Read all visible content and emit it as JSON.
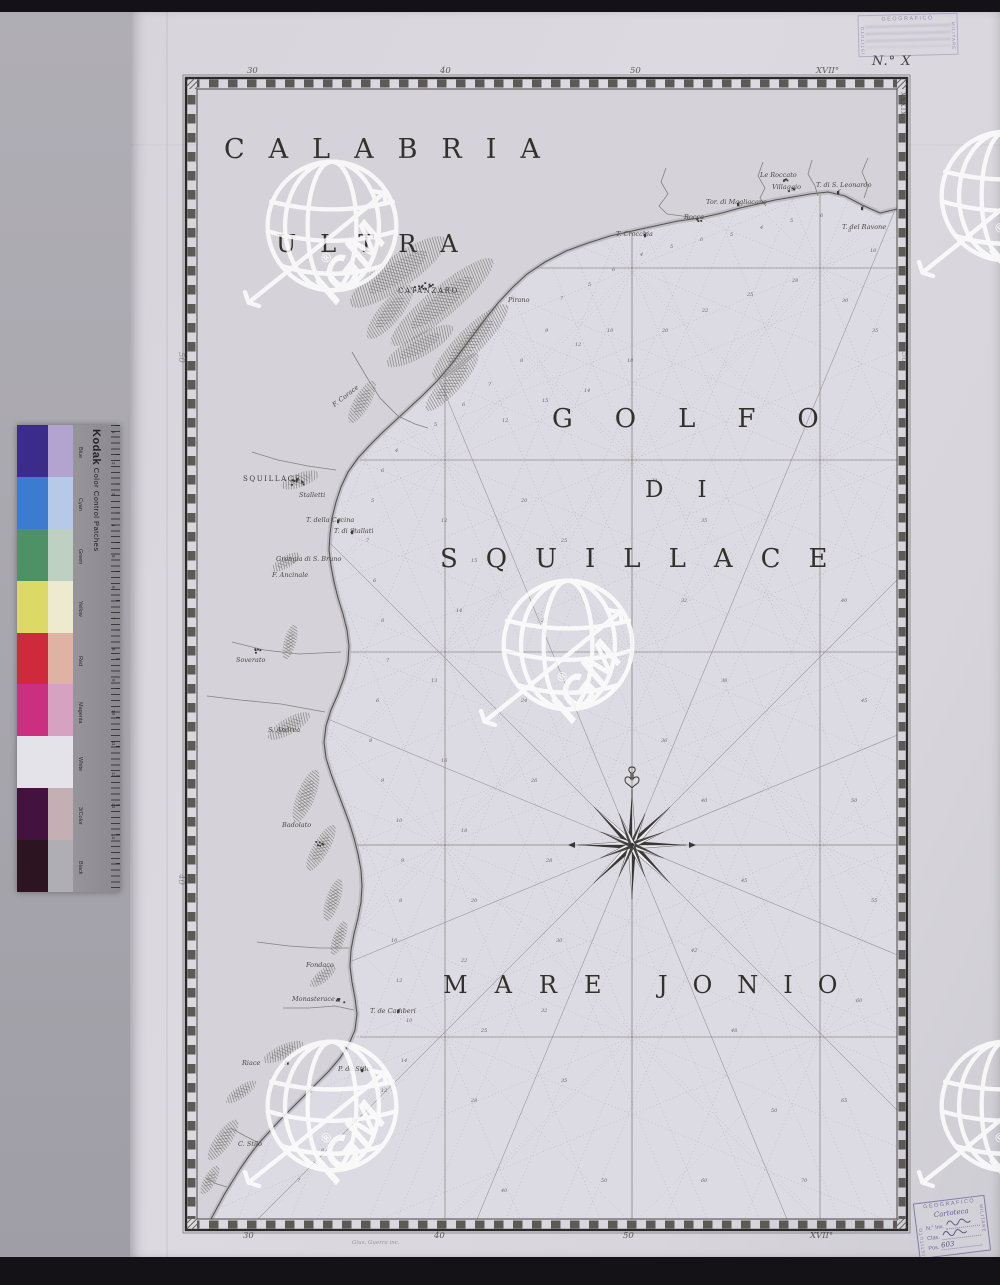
{
  "plate_number": "N.° X",
  "engraver_credit": "Gius. Guerra inc.",
  "watermark": {
    "label": "IGM",
    "reg": "®"
  },
  "stamps": {
    "top": {
      "org_left": "ISTITUTO",
      "org_top": "GEOGRAFICO",
      "org_right": "MILITARE"
    },
    "bottom": {
      "org_top": "GEOGRAFICO",
      "org_left": "ISTITUTO",
      "org_right": "MILITARE",
      "script": "Cartoteca",
      "fields": [
        {
          "label": "N.° Inv.",
          "value": ""
        },
        {
          "label": "Clas.",
          "value": ""
        },
        {
          "label": "Pos.",
          "value": "603"
        }
      ]
    }
  },
  "kodak": {
    "brand": "Kodak",
    "title": "Color Control Patches",
    "rows": [
      {
        "name": "Blue",
        "left": "#3b2b8b",
        "right": "#b3a4cf"
      },
      {
        "name": "Cyan",
        "left": "#3d7bd0",
        "right": "#b6c9e8"
      },
      {
        "name": "Green",
        "left": "#4e9166",
        "right": "#bdd0c1"
      },
      {
        "name": "Yellow",
        "left": "#ddd967",
        "right": "#eeeacf"
      },
      {
        "name": "Red",
        "left": "#cf2a3c",
        "right": "#dfb3a4"
      },
      {
        "name": "Magenta",
        "left": "#cc2f7f",
        "right": "#d5a2c2"
      },
      {
        "name": "White",
        "left": "#e4e3e9",
        "right": "#e4e3e9"
      },
      {
        "name": "3/Color",
        "left": "#43123f",
        "right": "#c4afb4"
      },
      {
        "name": "Black",
        "left": "#2c1420",
        "right": "#aeaeb4"
      }
    ],
    "ruler_numbers": [
      "1",
      "2",
      "3",
      "4",
      "5",
      "6",
      "7",
      "8",
      "9",
      "10",
      "11",
      "12",
      "13",
      "14"
    ]
  },
  "map": {
    "frame": {
      "outer": [
        186,
        78,
        907,
        1230
      ],
      "inner": [
        197,
        89,
        897,
        1219
      ]
    },
    "titles": [
      {
        "text": "CALABRIA",
        "x": 224,
        "y": 134,
        "fs": 27,
        "ls": 24
      },
      {
        "text": "ULTRA",
        "x": 276,
        "y": 230,
        "fs": 24,
        "ls": 24
      },
      {
        "text": "GOLFO",
        "x": 552,
        "y": 404,
        "fs": 26,
        "ls": 42
      },
      {
        "text": "DI",
        "x": 645,
        "y": 477,
        "fs": 23,
        "ls": 34
      },
      {
        "text": "SQUILLACE",
        "x": 440,
        "y": 544,
        "fs": 26,
        "ls": 28
      },
      {
        "text": "MARE",
        "x": 443,
        "y": 971,
        "fs": 24,
        "ls": 27
      },
      {
        "text": "JONIO",
        "x": 658,
        "y": 971,
        "fs": 24,
        "ls": 25
      }
    ],
    "towns_caps": [
      {
        "text": "CATANZARO",
        "x": 398,
        "y": 287
      },
      {
        "text": "SQUILLACE",
        "x": 243,
        "y": 475
      }
    ],
    "places": [
      [
        "Pirano",
        508,
        296
      ],
      [
        "T. Crocchia",
        616,
        230
      ],
      [
        "Rocca",
        684,
        213
      ],
      [
        "Tor. di Magliacane",
        706,
        198
      ],
      [
        "Le Roccato",
        760,
        171
      ],
      [
        "Villaggio",
        772,
        183
      ],
      [
        "T. di S. Leonardo",
        816,
        181
      ],
      [
        "T. del Ravone",
        842,
        223
      ],
      [
        "Stalletti",
        299,
        491
      ],
      [
        "T. della Cocina",
        306,
        516
      ],
      [
        "T. di Stallati",
        334,
        527
      ],
      [
        "Grangia di S. Bruno",
        276,
        555
      ],
      [
        "F. Ancinale",
        272,
        571
      ],
      [
        "Soverato",
        236,
        656
      ],
      [
        "S. Andrea",
        268,
        726
      ],
      [
        "Badolato",
        282,
        821
      ],
      [
        "Fondaco",
        306,
        961
      ],
      [
        "Monasterace",
        292,
        995
      ],
      [
        "T. de Camberi",
        370,
        1007
      ],
      [
        "Riace",
        242,
        1059
      ],
      [
        "P. de Stilo",
        338,
        1065
      ],
      [
        "C. Stilo",
        238,
        1140
      ],
      [
        "F. Corace",
        330,
        392,
        -38
      ]
    ],
    "border": {
      "top": [
        [
          "30",
          247
        ],
        [
          "40",
          440
        ],
        [
          "50",
          630
        ],
        [
          "XVII°",
          816
        ]
      ],
      "bottom": [
        [
          "30",
          243
        ],
        [
          "40",
          434
        ],
        [
          "50",
          623
        ],
        [
          "XVII°",
          810
        ]
      ],
      "left": [
        [
          "50",
          352
        ],
        [
          "40",
          874
        ]
      ],
      "right": [
        [
          "50",
          352
        ],
        [
          "40",
          874
        ]
      ],
      "roman": "XXXIX"
    },
    "grid": {
      "verticals": [
        [
          445,
          372
        ],
        [
          632,
          233
        ],
        [
          820,
          195
        ]
      ],
      "horizontals": [
        [
          268,
          537
        ],
        [
          460,
          360
        ],
        [
          652,
          351
        ],
        [
          845,
          358
        ],
        [
          1037,
          360
        ]
      ]
    },
    "rose": {
      "x": 632,
      "y": 845
    },
    "coast": [
      [
        897,
        209
      ],
      [
        880,
        213
      ],
      [
        862,
        205
      ],
      [
        845,
        196
      ],
      [
        828,
        192
      ],
      [
        810,
        194
      ],
      [
        793,
        197
      ],
      [
        775,
        200
      ],
      [
        758,
        204
      ],
      [
        740,
        208
      ],
      [
        722,
        213
      ],
      [
        700,
        218
      ],
      [
        678,
        221
      ],
      [
        655,
        226
      ],
      [
        632,
        231
      ],
      [
        610,
        236
      ],
      [
        588,
        243
      ],
      [
        566,
        251
      ],
      [
        545,
        262
      ],
      [
        527,
        274
      ],
      [
        512,
        288
      ],
      [
        498,
        303
      ],
      [
        486,
        318
      ],
      [
        474,
        334
      ],
      [
        462,
        350
      ],
      [
        450,
        366
      ],
      [
        437,
        381
      ],
      [
        423,
        395
      ],
      [
        409,
        408
      ],
      [
        396,
        420
      ],
      [
        383,
        432
      ],
      [
        370,
        445
      ],
      [
        358,
        458
      ],
      [
        348,
        472
      ],
      [
        341,
        487
      ],
      [
        336,
        502
      ],
      [
        332,
        518
      ],
      [
        330,
        534
      ],
      [
        329,
        550
      ],
      [
        331,
        566
      ],
      [
        334,
        582
      ],
      [
        338,
        598
      ],
      [
        343,
        614
      ],
      [
        347,
        630
      ],
      [
        349,
        646
      ],
      [
        348,
        662
      ],
      [
        344,
        678
      ],
      [
        338,
        694
      ],
      [
        331,
        710
      ],
      [
        326,
        726
      ],
      [
        324,
        742
      ],
      [
        326,
        758
      ],
      [
        331,
        774
      ],
      [
        337,
        790
      ],
      [
        343,
        806
      ],
      [
        349,
        822
      ],
      [
        354,
        838
      ],
      [
        358,
        854
      ],
      [
        361,
        870
      ],
      [
        362,
        886
      ],
      [
        361,
        902
      ],
      [
        358,
        918
      ],
      [
        354,
        934
      ],
      [
        351,
        950
      ],
      [
        350,
        966
      ],
      [
        352,
        982
      ],
      [
        355,
        998
      ],
      [
        357,
        1014
      ],
      [
        355,
        1030
      ],
      [
        349,
        1044
      ],
      [
        340,
        1058
      ],
      [
        329,
        1071
      ],
      [
        317,
        1083
      ],
      [
        305,
        1095
      ],
      [
        293,
        1107
      ],
      [
        281,
        1119
      ],
      [
        270,
        1131
      ],
      [
        259,
        1143
      ],
      [
        249,
        1156
      ],
      [
        240,
        1169
      ],
      [
        232,
        1182
      ],
      [
        224,
        1195
      ],
      [
        217,
        1208
      ],
      [
        211,
        1219
      ]
    ],
    "relief": [
      [
        398,
        272,
        58,
        16,
        -35
      ],
      [
        442,
        302,
        66,
        15,
        -40
      ],
      [
        470,
        342,
        52,
        13,
        -45
      ],
      [
        420,
        346,
        38,
        11,
        -30
      ],
      [
        390,
        312,
        34,
        11,
        -50
      ],
      [
        452,
        382,
        38,
        10,
        -48
      ],
      [
        362,
        402,
        24,
        8,
        -60
      ],
      [
        300,
        480,
        20,
        7,
        -20
      ],
      [
        286,
        562,
        16,
        6,
        -30
      ],
      [
        290,
        642,
        18,
        6,
        -75
      ],
      [
        289,
        726,
        24,
        8,
        -30
      ],
      [
        306,
        796,
        28,
        9,
        -68
      ],
      [
        321,
        848,
        26,
        8,
        -60
      ],
      [
        333,
        900,
        22,
        7,
        -72
      ],
      [
        339,
        938,
        18,
        6,
        -70
      ],
      [
        323,
        976,
        16,
        6,
        -40
      ],
      [
        283,
        1052,
        22,
        7,
        -25
      ],
      [
        241,
        1092,
        18,
        6,
        -35
      ],
      [
        223,
        1140,
        24,
        8,
        -55
      ],
      [
        210,
        1180,
        16,
        6,
        -60
      ]
    ],
    "rivers": [
      [
        [
          666,
          168
        ],
        [
          661,
          182
        ],
        [
          668,
          194
        ],
        [
          659,
          206
        ],
        [
          667,
          214
        ],
        [
          690,
          217
        ]
      ],
      [
        [
          763,
          162
        ],
        [
          758,
          176
        ],
        [
          765,
          188
        ],
        [
          760,
          198
        ],
        [
          766,
          206
        ]
      ],
      [
        [
          812,
          160
        ],
        [
          808,
          174
        ],
        [
          815,
          186
        ],
        [
          818,
          196
        ]
      ],
      [
        [
          868,
          158
        ],
        [
          862,
          172
        ],
        [
          868,
          186
        ],
        [
          864,
          198
        ]
      ],
      [
        [
          352,
          352
        ],
        [
          366,
          376
        ],
        [
          380,
          398
        ],
        [
          398,
          416
        ],
        [
          415,
          424
        ],
        [
          428,
          428
        ]
      ],
      [
        [
          252,
          452
        ],
        [
          278,
          460
        ],
        [
          308,
          466
        ],
        [
          336,
          470
        ]
      ],
      [
        [
          232,
          642
        ],
        [
          264,
          650
        ],
        [
          299,
          654
        ],
        [
          341,
          652
        ]
      ],
      [
        [
          207,
          696
        ],
        [
          240,
          700
        ],
        [
          281,
          704
        ],
        [
          325,
          712
        ]
      ],
      [
        [
          257,
          942
        ],
        [
          289,
          946
        ],
        [
          319,
          948
        ],
        [
          349,
          948
        ]
      ],
      [
        [
          283,
          1008
        ],
        [
          309,
          1008
        ],
        [
          335,
          1006
        ],
        [
          354,
          1010
        ]
      ],
      [
        [
          231,
          1128
        ],
        [
          245,
          1136
        ],
        [
          257,
          1142
        ]
      ],
      [
        [
          206,
          1178
        ],
        [
          217,
          1184
        ],
        [
          227,
          1187
        ]
      ]
    ],
    "towns": [
      [
        424,
        286,
        14,
        20,
        8
      ],
      [
        299,
        481,
        10,
        16,
        6
      ],
      [
        318,
        843,
        6,
        9,
        4
      ],
      [
        340,
        1000,
        6,
        9,
        4
      ],
      [
        287,
        1062,
        5,
        8,
        4
      ],
      [
        258,
        650,
        5,
        8,
        4
      ],
      [
        783,
        179,
        5,
        8,
        3
      ],
      [
        791,
        189,
        4,
        7,
        3
      ],
      [
        697,
        219,
        4,
        7,
        3
      ]
    ],
    "towers": [
      [
        838,
        194
      ],
      [
        738,
        206
      ],
      [
        645,
        237
      ],
      [
        338,
        523
      ],
      [
        352,
        534
      ],
      [
        398,
        1013
      ],
      [
        362,
        1072
      ],
      [
        862,
        210
      ]
    ],
    "soundings": [
      [
        560,
        300,
        7
      ],
      [
        588,
        286,
        5
      ],
      [
        612,
        271,
        6
      ],
      [
        640,
        256,
        4
      ],
      [
        670,
        248,
        5
      ],
      [
        700,
        241,
        6
      ],
      [
        730,
        236,
        5
      ],
      [
        760,
        229,
        4
      ],
      [
        790,
        222,
        5
      ],
      [
        820,
        217,
        6
      ],
      [
        848,
        232,
        8
      ],
      [
        870,
        252,
        10
      ],
      [
        545,
        332,
        9
      ],
      [
        575,
        346,
        12
      ],
      [
        607,
        332,
        10
      ],
      [
        520,
        362,
        8
      ],
      [
        488,
        386,
        7
      ],
      [
        462,
        406,
        6
      ],
      [
        434,
        426,
        5
      ],
      [
        502,
        422,
        12
      ],
      [
        542,
        402,
        15
      ],
      [
        584,
        392,
        14
      ],
      [
        627,
        362,
        18
      ],
      [
        662,
        332,
        20
      ],
      [
        702,
        312,
        22
      ],
      [
        747,
        296,
        25
      ],
      [
        792,
        282,
        28
      ],
      [
        842,
        302,
        30
      ],
      [
        872,
        332,
        35
      ],
      [
        395,
        452,
        4
      ],
      [
        381,
        472,
        6
      ],
      [
        371,
        502,
        5
      ],
      [
        366,
        542,
        7
      ],
      [
        373,
        582,
        6
      ],
      [
        381,
        622,
        8
      ],
      [
        386,
        662,
        7
      ],
      [
        376,
        702,
        6
      ],
      [
        369,
        742,
        8
      ],
      [
        381,
        782,
        9
      ],
      [
        396,
        822,
        10
      ],
      [
        401,
        862,
        9
      ],
      [
        399,
        902,
        8
      ],
      [
        391,
        942,
        10
      ],
      [
        396,
        982,
        12
      ],
      [
        406,
        1022,
        10
      ],
      [
        401,
        1062,
        14
      ],
      [
        381,
        1092,
        12
      ],
      [
        351,
        1122,
        10
      ],
      [
        321,
        1152,
        8
      ],
      [
        297,
        1182,
        7
      ],
      [
        441,
        522,
        12
      ],
      [
        471,
        562,
        15
      ],
      [
        456,
        612,
        14
      ],
      [
        431,
        682,
        13
      ],
      [
        441,
        762,
        16
      ],
      [
        461,
        832,
        18
      ],
      [
        471,
        902,
        20
      ],
      [
        461,
        962,
        22
      ],
      [
        481,
        1032,
        25
      ],
      [
        471,
        1102,
        28
      ],
      [
        521,
        502,
        20
      ],
      [
        561,
        542,
        25
      ],
      [
        541,
        622,
        22
      ],
      [
        521,
        702,
        24
      ],
      [
        531,
        782,
        26
      ],
      [
        546,
        862,
        28
      ],
      [
        556,
        942,
        30
      ],
      [
        541,
        1012,
        32
      ],
      [
        561,
        1082,
        35
      ],
      [
        651,
        482,
        30
      ],
      [
        701,
        522,
        35
      ],
      [
        681,
        602,
        32
      ],
      [
        721,
        682,
        38
      ],
      [
        661,
        742,
        36
      ],
      [
        701,
        802,
        40
      ],
      [
        741,
        882,
        45
      ],
      [
        691,
        952,
        42
      ],
      [
        731,
        1032,
        48
      ],
      [
        771,
        1112,
        50
      ],
      [
        841,
        602,
        40
      ],
      [
        861,
        702,
        45
      ],
      [
        851,
        802,
        50
      ],
      [
        871,
        902,
        55
      ],
      [
        856,
        1002,
        60
      ],
      [
        841,
        1102,
        65
      ],
      [
        801,
        1182,
        70
      ],
      [
        701,
        1182,
        60
      ],
      [
        601,
        1182,
        50
      ],
      [
        501,
        1192,
        40
      ]
    ]
  }
}
